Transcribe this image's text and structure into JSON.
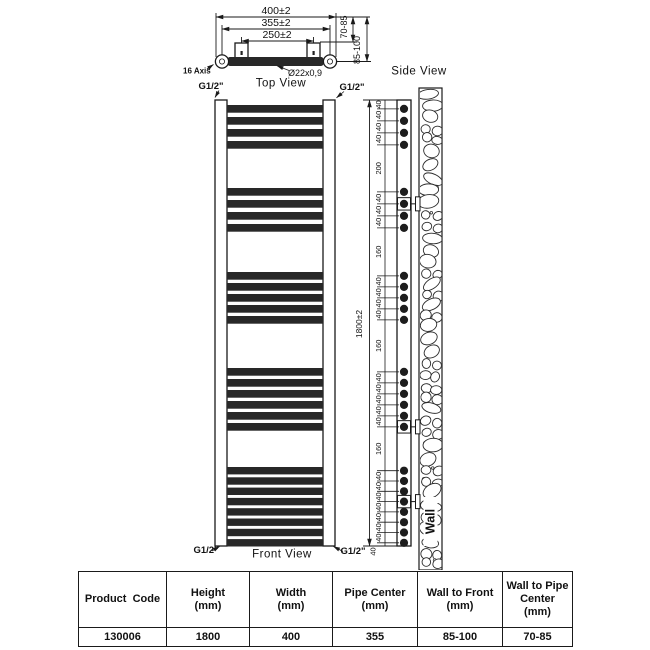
{
  "top_view": {
    "title": "Top View",
    "dim_width": "400±2",
    "dim_pipe_center": "355±2",
    "dim_bracket_center": "250±2",
    "dim_wall_to_pipe": "70-85",
    "dim_wall_to_front": "85-100",
    "tube_label": "Ø22x0,9",
    "axis_label": "16 Axis"
  },
  "front_view": {
    "title": "Front View",
    "fitting_label": "G1/2\"",
    "rung_groups": [
      4,
      4,
      5,
      6,
      8
    ]
  },
  "side_view": {
    "title": "Side View",
    "wall_label": "Wall",
    "dim_height": "1800±2",
    "dim_chain": [
      "40",
      "40",
      "40",
      "40",
      "200",
      "40",
      "40",
      "40",
      "160",
      "40",
      "40",
      "40",
      "40",
      "160",
      "40",
      "40",
      "40",
      "40",
      "40",
      "160",
      "40",
      "40",
      "40",
      "40",
      "40",
      "40",
      "40",
      "40"
    ]
  },
  "table": {
    "headers": [
      [
        "Product  Code"
      ],
      [
        "Height",
        "(mm)"
      ],
      [
        "Width",
        "(mm)"
      ],
      [
        "Pipe Center",
        "(mm)"
      ],
      [
        "Wall to Front",
        "(mm)"
      ],
      [
        "Wall to Pipe",
        "Center",
        "(mm)"
      ]
    ],
    "row": [
      "130006",
      "1800",
      "400",
      "355",
      "85-100",
      "70-85"
    ]
  },
  "colors": {
    "bar": "#282828",
    "line": "#1a1a1a"
  }
}
